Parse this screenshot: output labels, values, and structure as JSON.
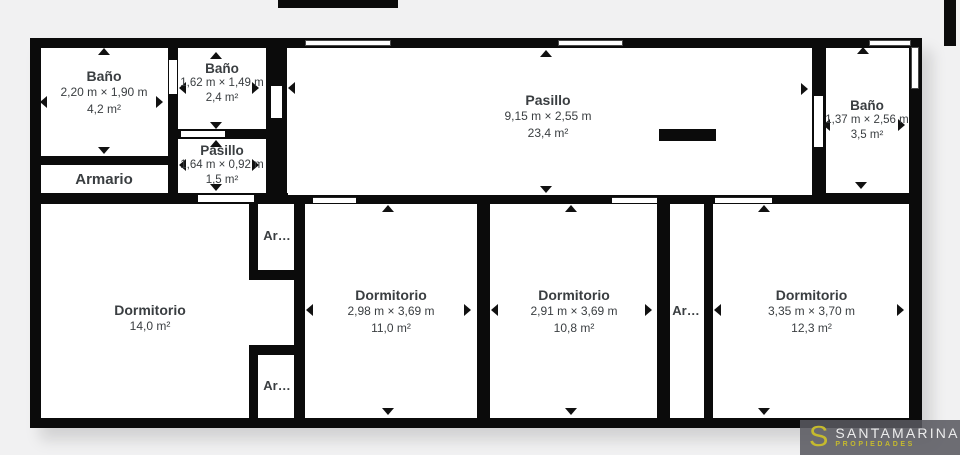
{
  "colors": {
    "background": "#f1f1f2",
    "wall": "#0b0b0b",
    "floor": "#ffffff",
    "text": "#3a3e41",
    "logo_bg": "#58585f",
    "logo_accent": "#c5ba2e",
    "logo_text": "#ececec"
  },
  "rooms": {
    "bano1": {
      "name": "Baño",
      "dims": "2,20 m × 1,90 m",
      "area": "4,2 m²"
    },
    "bano2": {
      "name": "Baño",
      "dims": "1,62 m × 1,49 m",
      "area": "2,4 m²"
    },
    "armario": {
      "name": "Armario"
    },
    "pasillo_small": {
      "name": "Pasillo",
      "dims": "1,64 m × 0,92 m",
      "area": "1,5 m²"
    },
    "pasillo_main": {
      "name": "Pasillo",
      "dims": "9,15 m × 2,55 m",
      "area": "23,4 m²"
    },
    "bano3": {
      "name": "Baño",
      "dims": "1,37 m × 2,56 m",
      "area": "3,5 m²"
    },
    "dorm1": {
      "name": "Dormitorio",
      "area": "14,0 m²"
    },
    "dorm2": {
      "name": "Dormitorio",
      "dims": "2,98 m × 3,69 m",
      "area": "11,0 m²"
    },
    "dorm3": {
      "name": "Dormitorio",
      "dims": "2,91 m × 3,69 m",
      "area": "10,8 m²"
    },
    "dorm4": {
      "name": "Dormitorio",
      "dims": "3,35 m × 3,70 m",
      "area": "12,3 m²"
    },
    "closet1": {
      "name": "Ar…"
    },
    "closet2": {
      "name": "Ar…"
    },
    "closet3": {
      "name": "Ar…"
    }
  },
  "logo": {
    "initial": "S",
    "brand": "SANTAMARINA",
    "tagline": "PROPIEDADES"
  }
}
